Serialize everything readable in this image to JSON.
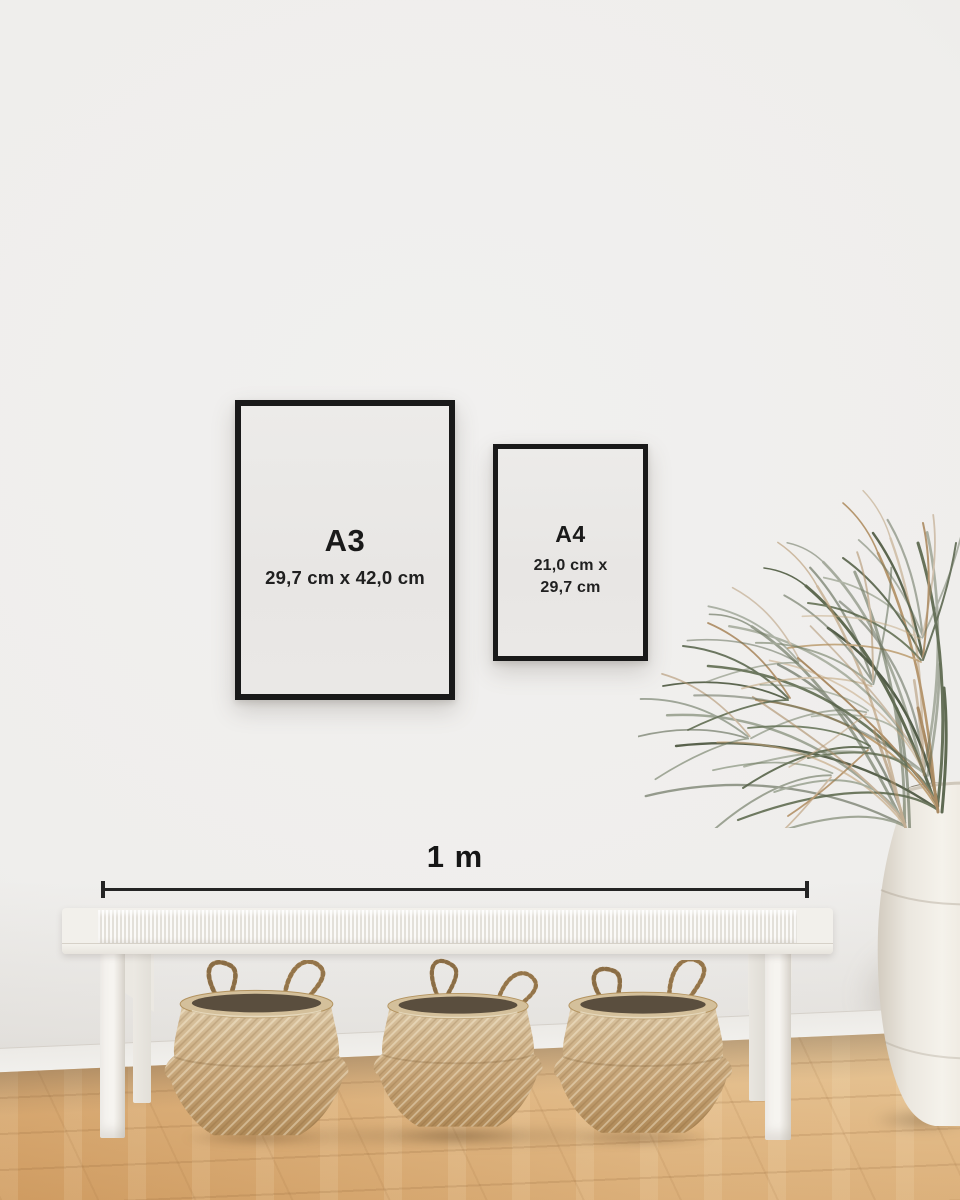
{
  "frames": [
    {
      "id": "a3",
      "label": "A3",
      "dimensions": "29,7 cm x 42,0 cm"
    },
    {
      "id": "a4",
      "label": "A4",
      "dimensions_line1": "21,0 cm x",
      "dimensions_line2": "29,7 cm"
    }
  ],
  "scale_bar": {
    "label": "1 m"
  },
  "colors": {
    "wall": "#efeeec",
    "frame": "#191919",
    "poster_paper": "#eae8e6",
    "text": "#1a1a1a",
    "floor_wood": "#dcb07a",
    "bench": "#f2f0eb",
    "basket": "#c9a87c",
    "basket_interior": "#5a4e3e",
    "plant_green": "#66705a",
    "plant_dried": "#b4946e",
    "vase": "#efebe3"
  }
}
